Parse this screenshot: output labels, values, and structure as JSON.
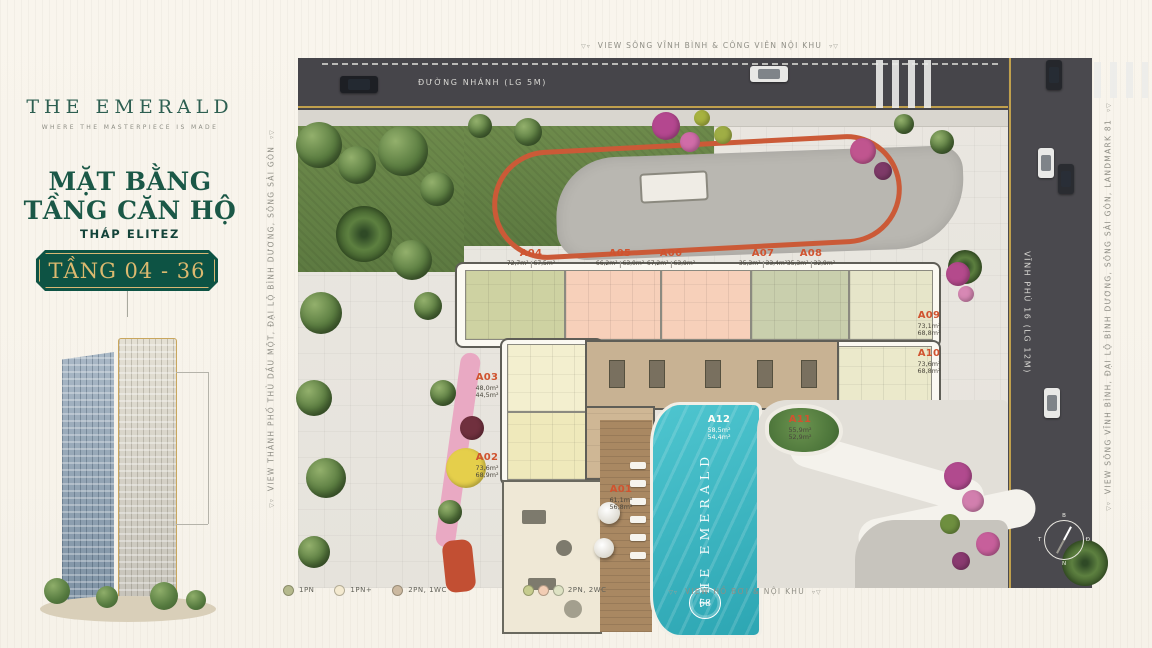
{
  "sidebar": {
    "brand_title": "THE EMERALD",
    "brand_tagline": "WHERE THE MASTERPIECE IS MADE",
    "heading_line1": "MẶT BẰNG",
    "heading_line2": "TẦNG CĂN HỘ",
    "tower_name": "THÁP ELITEZ",
    "floor_range": "TẦNG 04 - 36"
  },
  "plan": {
    "views": {
      "top": "VIEW SÔNG VĨNH BÌNH & CÔNG VIÊN NỘI KHU",
      "bottom": "VIEW HỒ BƠI & NỘI KHU",
      "left": "VIEW  THÀNH PHỐ THỦ DẦU MỘT, ĐẠI LỘ BÌNH DƯƠNG, SÔNG SÀI GÒN",
      "right": "VIEW SÔNG VĨNH BÌNH, ĐẠI LỘ BÌNH DƯƠNG, SÔNG SÀI GÒN, LANDMARK 81"
    },
    "roads": {
      "top_label": "ĐƯỜNG NHÁNH (LG 5M)",
      "right_label": "VĨNH PHÚ 16 (LG 12M)"
    },
    "pool": {
      "name": "THE EMERALD",
      "logo": "68"
    },
    "compass": {
      "north": "B",
      "east": "Đ",
      "south": "N",
      "west": "T"
    },
    "units": [
      {
        "id": "A01",
        "area1": "61,1m²",
        "area2": "56,8m²"
      },
      {
        "id": "A02",
        "area1": "73,6m²",
        "area2": "68,9m²"
      },
      {
        "id": "A03",
        "area1": "48,0m²",
        "area2": "44,5m²"
      },
      {
        "id": "A04",
        "area1": "72,7m²",
        "area2": "67,5m²"
      },
      {
        "id": "A05",
        "area1": "66,2m²",
        "area2": "63,0m²"
      },
      {
        "id": "A06",
        "area1": "67,2m²",
        "area2": "63,9m²"
      },
      {
        "id": "A07",
        "area1": "35,3m²",
        "area2": "33,4m²"
      },
      {
        "id": "A08",
        "area1": "35,3m²",
        "area2": "32,9m²"
      },
      {
        "id": "A09",
        "area1": "73,1m²",
        "area2": "68,8m²"
      },
      {
        "id": "A10",
        "area1": "73,6m²",
        "area2": "68,8m²"
      },
      {
        "id": "A11",
        "area1": "55,9m²",
        "area2": "52,9m²"
      },
      {
        "id": "A12",
        "area1": "58,5m²",
        "area2": "54,4m²"
      }
    ],
    "legend": [
      {
        "label": "1PN",
        "colors": [
          "#b5b98c"
        ]
      },
      {
        "label": "1PN+",
        "colors": [
          "#f4ead0"
        ]
      },
      {
        "label": "2PN, 1WC",
        "colors": [
          "#ccb9a0"
        ]
      },
      {
        "label": "2PN, 2WC",
        "colors": [
          "#c6cc8e",
          "#f2cdb4",
          "#dde2c3"
        ]
      }
    ]
  },
  "colors": {
    "brand_green": "#1b5847",
    "badge_green": "#0d5344",
    "badge_gold": "#dcb96f",
    "unit_label_orange": "#d0532f",
    "pool_teal": "#3db6c1",
    "road_dark": "#46454a"
  }
}
